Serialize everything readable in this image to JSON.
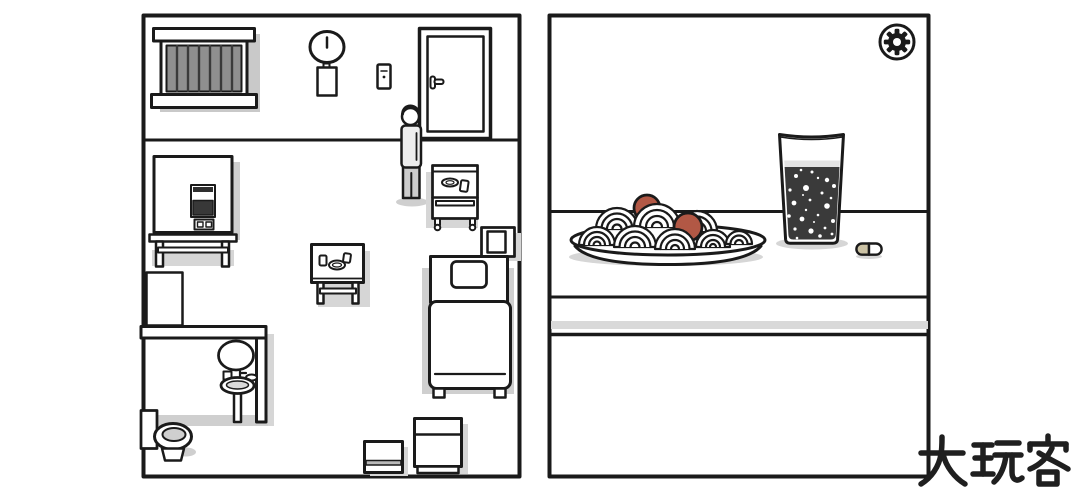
{
  "watermark": {
    "text": "大玩客"
  },
  "panels": {
    "left": {
      "name": "room-map-panel"
    },
    "right": {
      "name": "table-scene-panel"
    }
  },
  "left_panel": {
    "items": [
      "barred-window",
      "wall-clock",
      "paper-note",
      "light-switch",
      "door",
      "person",
      "food-machine",
      "serving-cart",
      "nightstand",
      "bed",
      "side-table",
      "bathroom-cabinet",
      "bathroom-wall",
      "mirror",
      "pedestal-sink",
      "toilet",
      "storage-box-small",
      "storage-box-large"
    ]
  },
  "right_panel": {
    "items": [
      "settings-gear-button",
      "spaghetti-plate",
      "meatball",
      "meatball",
      "cola-glass",
      "pill"
    ]
  },
  "colors": {
    "outline": "#1a1a1a",
    "window_glass": "#8f8f8f",
    "window_bar": "#3a3a3a",
    "screen_dark": "#383838",
    "machine_strip": "#2f2f2f",
    "cola": "#3a3a3a",
    "foam": "#e3e3e3",
    "meatball": "#b25845",
    "pill_half": "#cbc2a4",
    "shirt": "#ededed",
    "pants": "#cccccc",
    "seat_gray": "#cfcfcf",
    "shadow": "#cfcfcf",
    "shadow_soft": "#d6d6d6",
    "watermark": "#1f1f1f"
  }
}
